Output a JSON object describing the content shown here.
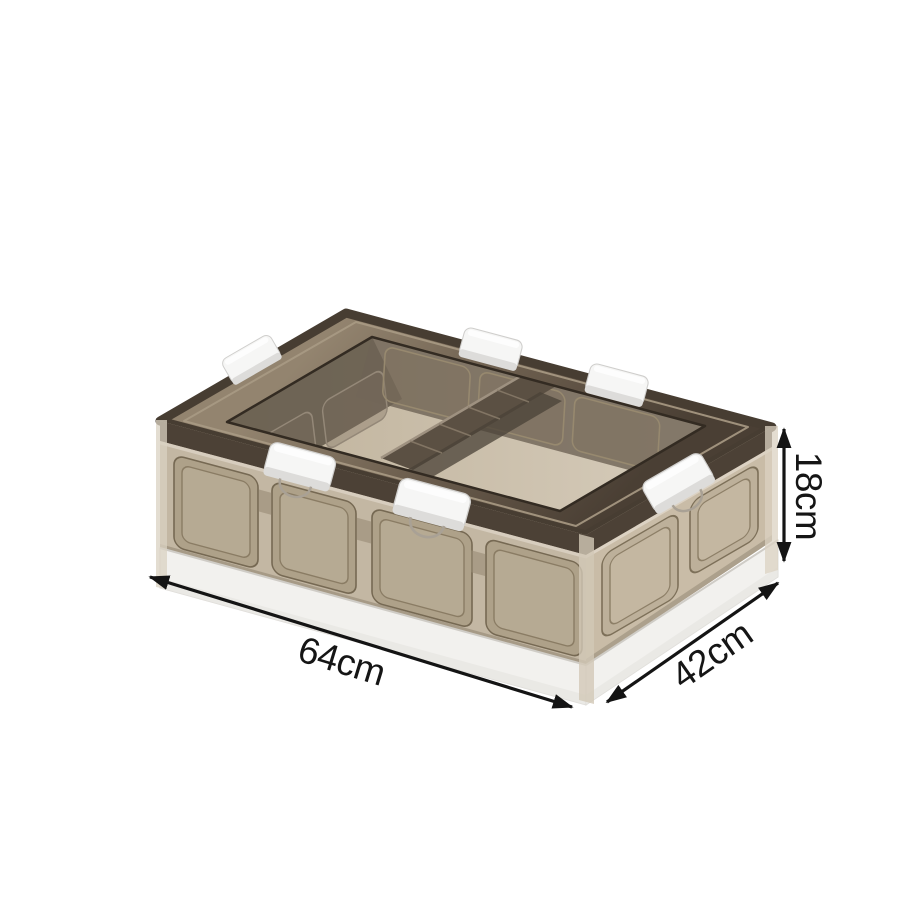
{
  "scene": {
    "background": "#ffffff",
    "description": "Product photo of a collapsible transparent storage crate with dimension annotations"
  },
  "product": {
    "name": "folding-storage-crate",
    "plastic_tint": "#c3b7a3",
    "panel_tint": "#aea189",
    "right_face_tint": "#c9bca7",
    "rim_dark": "#4c4136",
    "interior_floor": "#cdc2ae",
    "clip_white": "#f6f6f5",
    "base_white": "#f2f1ee"
  },
  "annotations": {
    "length_label": "64cm",
    "width_label": "42cm",
    "height_label": "18cm",
    "arrow_color": "#141414",
    "text_color": "#151515"
  }
}
